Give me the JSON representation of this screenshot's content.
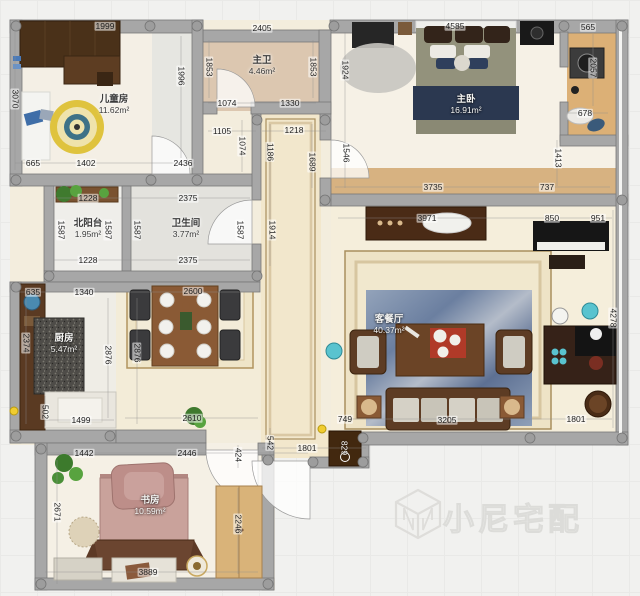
{
  "watermark": {
    "brand": "小尼宅配"
  },
  "rooms": [
    {
      "id": "kids-room",
      "name": "儿童房",
      "area": "11.62m²",
      "x": 114,
      "y": 103,
      "light": false
    },
    {
      "id": "master-bath",
      "name": "主卫",
      "area": "4.46m²",
      "x": 262,
      "y": 64,
      "light": false
    },
    {
      "id": "master-bedroom",
      "name": "主卧",
      "area": "16.91m²",
      "x": 466,
      "y": 103,
      "light": true
    },
    {
      "id": "north-balcony",
      "name": "北阳台",
      "area": "1.95m²",
      "x": 88,
      "y": 227,
      "light": false
    },
    {
      "id": "bathroom",
      "name": "卫生间",
      "area": "3.77m²",
      "x": 186,
      "y": 227,
      "light": false
    },
    {
      "id": "kitchen",
      "name": "厨房",
      "area": "5.47m²",
      "x": 64,
      "y": 342,
      "light": true
    },
    {
      "id": "living-dining",
      "name": "客餐厅",
      "area": "40.37m²",
      "x": 389,
      "y": 323,
      "light": true
    },
    {
      "id": "study",
      "name": "书房",
      "area": "10.59m²",
      "x": 150,
      "y": 504,
      "light": true
    }
  ],
  "dimensions": [
    {
      "t": "1999",
      "x": 105,
      "y": 26
    },
    {
      "t": "2405",
      "x": 262,
      "y": 28
    },
    {
      "t": "4585",
      "x": 455,
      "y": 26
    },
    {
      "t": "565",
      "x": 588,
      "y": 27
    },
    {
      "t": "3070",
      "x": 15,
      "y": 99,
      "v": true
    },
    {
      "t": "1996",
      "x": 181,
      "y": 76,
      "v": true
    },
    {
      "t": "1853",
      "x": 209,
      "y": 67,
      "v": true
    },
    {
      "t": "1853",
      "x": 313,
      "y": 67,
      "v": true
    },
    {
      "t": "1924",
      "x": 345,
      "y": 70,
      "v": true
    },
    {
      "t": "2057",
      "x": 593,
      "y": 68,
      "v": true
    },
    {
      "t": "678",
      "x": 585,
      "y": 113
    },
    {
      "t": "1413",
      "x": 558,
      "y": 158,
      "v": true
    },
    {
      "t": "1074",
      "x": 227,
      "y": 103
    },
    {
      "t": "1330",
      "x": 290,
      "y": 103
    },
    {
      "t": "1105",
      "x": 222,
      "y": 131
    },
    {
      "t": "1218",
      "x": 294,
      "y": 130
    },
    {
      "t": "1074",
      "x": 242,
      "y": 146,
      "v": true
    },
    {
      "t": "1186",
      "x": 270,
      "y": 152,
      "v": true
    },
    {
      "t": "1689",
      "x": 312,
      "y": 162,
      "v": true
    },
    {
      "t": "1914",
      "x": 272,
      "y": 230,
      "v": true
    },
    {
      "t": "1546",
      "x": 346,
      "y": 153,
      "v": true
    },
    {
      "t": "3735",
      "x": 433,
      "y": 187
    },
    {
      "t": "737",
      "x": 547,
      "y": 187
    },
    {
      "t": "665",
      "x": 33,
      "y": 163
    },
    {
      "t": "1402",
      "x": 86,
      "y": 163
    },
    {
      "t": "2436",
      "x": 183,
      "y": 163
    },
    {
      "t": "1228",
      "x": 88,
      "y": 198
    },
    {
      "t": "2375",
      "x": 188,
      "y": 198
    },
    {
      "t": "1587",
      "x": 61,
      "y": 230,
      "v": true
    },
    {
      "t": "1587",
      "x": 108,
      "y": 230,
      "v": true
    },
    {
      "t": "1587",
      "x": 137,
      "y": 230,
      "v": true
    },
    {
      "t": "1587",
      "x": 240,
      "y": 230,
      "v": true
    },
    {
      "t": "1228",
      "x": 88,
      "y": 260
    },
    {
      "t": "2375",
      "x": 188,
      "y": 260
    },
    {
      "t": "635",
      "x": 33,
      "y": 292
    },
    {
      "t": "1340",
      "x": 84,
      "y": 292
    },
    {
      "t": "2600",
      "x": 193,
      "y": 291
    },
    {
      "t": "2374",
      "x": 26,
      "y": 343,
      "v": true
    },
    {
      "t": "2876",
      "x": 108,
      "y": 355,
      "v": true
    },
    {
      "t": "2876",
      "x": 137,
      "y": 353,
      "v": true
    },
    {
      "t": "3971",
      "x": 427,
      "y": 218
    },
    {
      "t": "850",
      "x": 552,
      "y": 218
    },
    {
      "t": "951",
      "x": 598,
      "y": 218
    },
    {
      "t": "4278",
      "x": 613,
      "y": 318,
      "v": true
    },
    {
      "t": "502",
      "x": 45,
      "y": 412,
      "v": true
    },
    {
      "t": "1499",
      "x": 81,
      "y": 420
    },
    {
      "t": "2610",
      "x": 192,
      "y": 418
    },
    {
      "t": "749",
      "x": 345,
      "y": 419
    },
    {
      "t": "3205",
      "x": 447,
      "y": 420
    },
    {
      "t": "1801",
      "x": 576,
      "y": 419
    },
    {
      "t": "542",
      "x": 270,
      "y": 443,
      "v": true
    },
    {
      "t": "1801",
      "x": 307,
      "y": 448
    },
    {
      "t": "829",
      "x": 344,
      "y": 448,
      "v": true,
      "light": true
    },
    {
      "t": "424",
      "x": 238,
      "y": 455,
      "v": true
    },
    {
      "t": "1442",
      "x": 84,
      "y": 453
    },
    {
      "t": "2446",
      "x": 187,
      "y": 453
    },
    {
      "t": "2671",
      "x": 57,
      "y": 512,
      "v": true
    },
    {
      "t": "2246",
      "x": 238,
      "y": 524,
      "v": true
    },
    {
      "t": "3889",
      "x": 148,
      "y": 572
    }
  ]
}
